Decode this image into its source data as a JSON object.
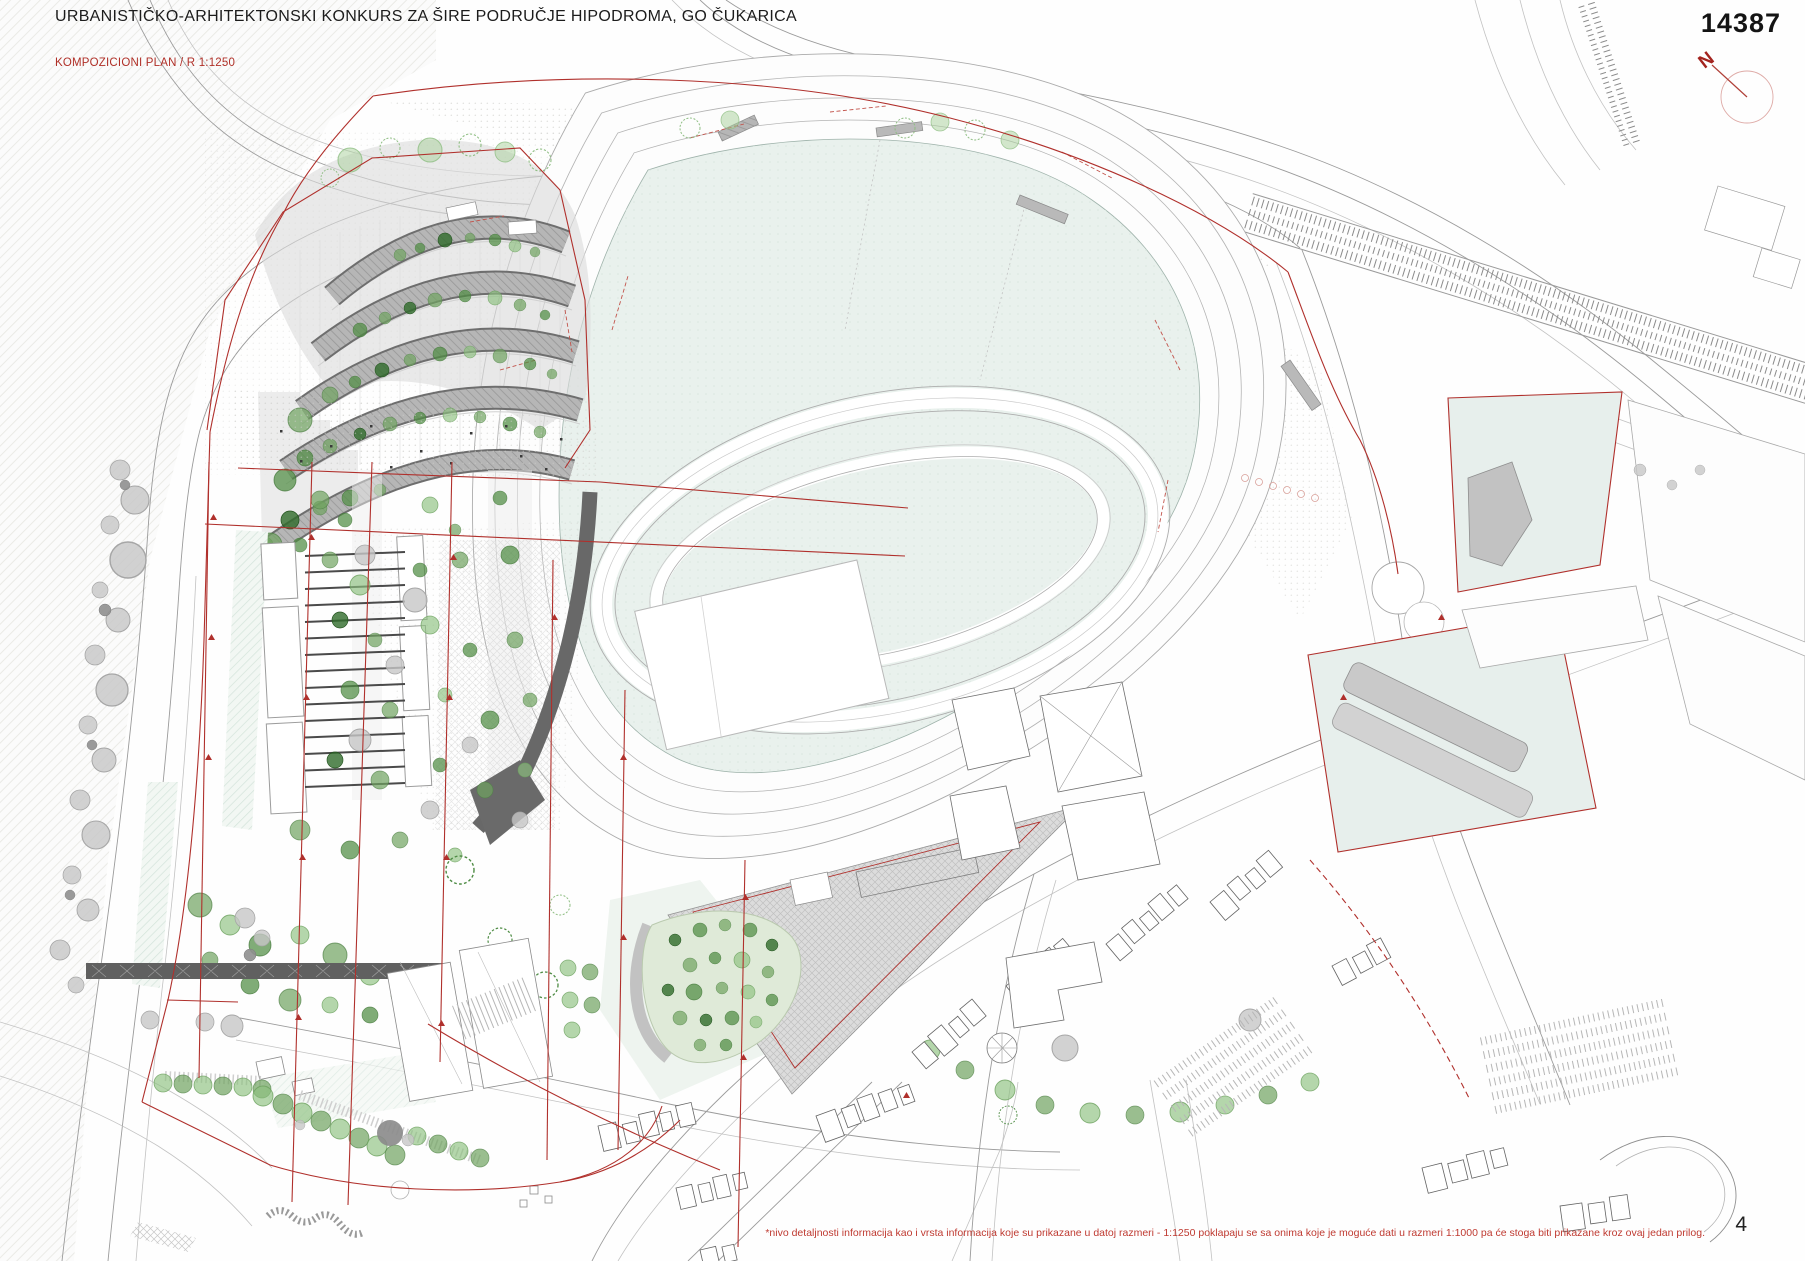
{
  "sheet": {
    "title": "URBANISTIČKO-ARHITEKTONSKI KONKURS ZA ŠIRE PODRUČJE HIPODROMA, GO ČUKARICA",
    "plan_label": "KOMPOZICIONI PLAN /  R 1:1250",
    "entry_code": "14387",
    "north_label": "N",
    "footnote": "*nivo detaljnosti informacija kao i vrsta informacija koje su prikazane u datoj razmeri - 1:1250 poklapaju se sa onima koje je moguće dati u razmeri 1:1000 pa će stoga biti prikazane kroz ovaj jedan prilog.",
    "page_number": "4"
  },
  "palette": {
    "paper": "#fefefe",
    "line_gray": "#9b9b9b",
    "boundary_red": "#b0302c",
    "annotation_red": "#bf3a31",
    "infield_teal": "#e9f1ed",
    "building_gray": "#b3b3b3",
    "dark_gray": "#5f5f5f",
    "tree_green": "#6fa35f",
    "tree_gray": "#c7c7c7"
  }
}
